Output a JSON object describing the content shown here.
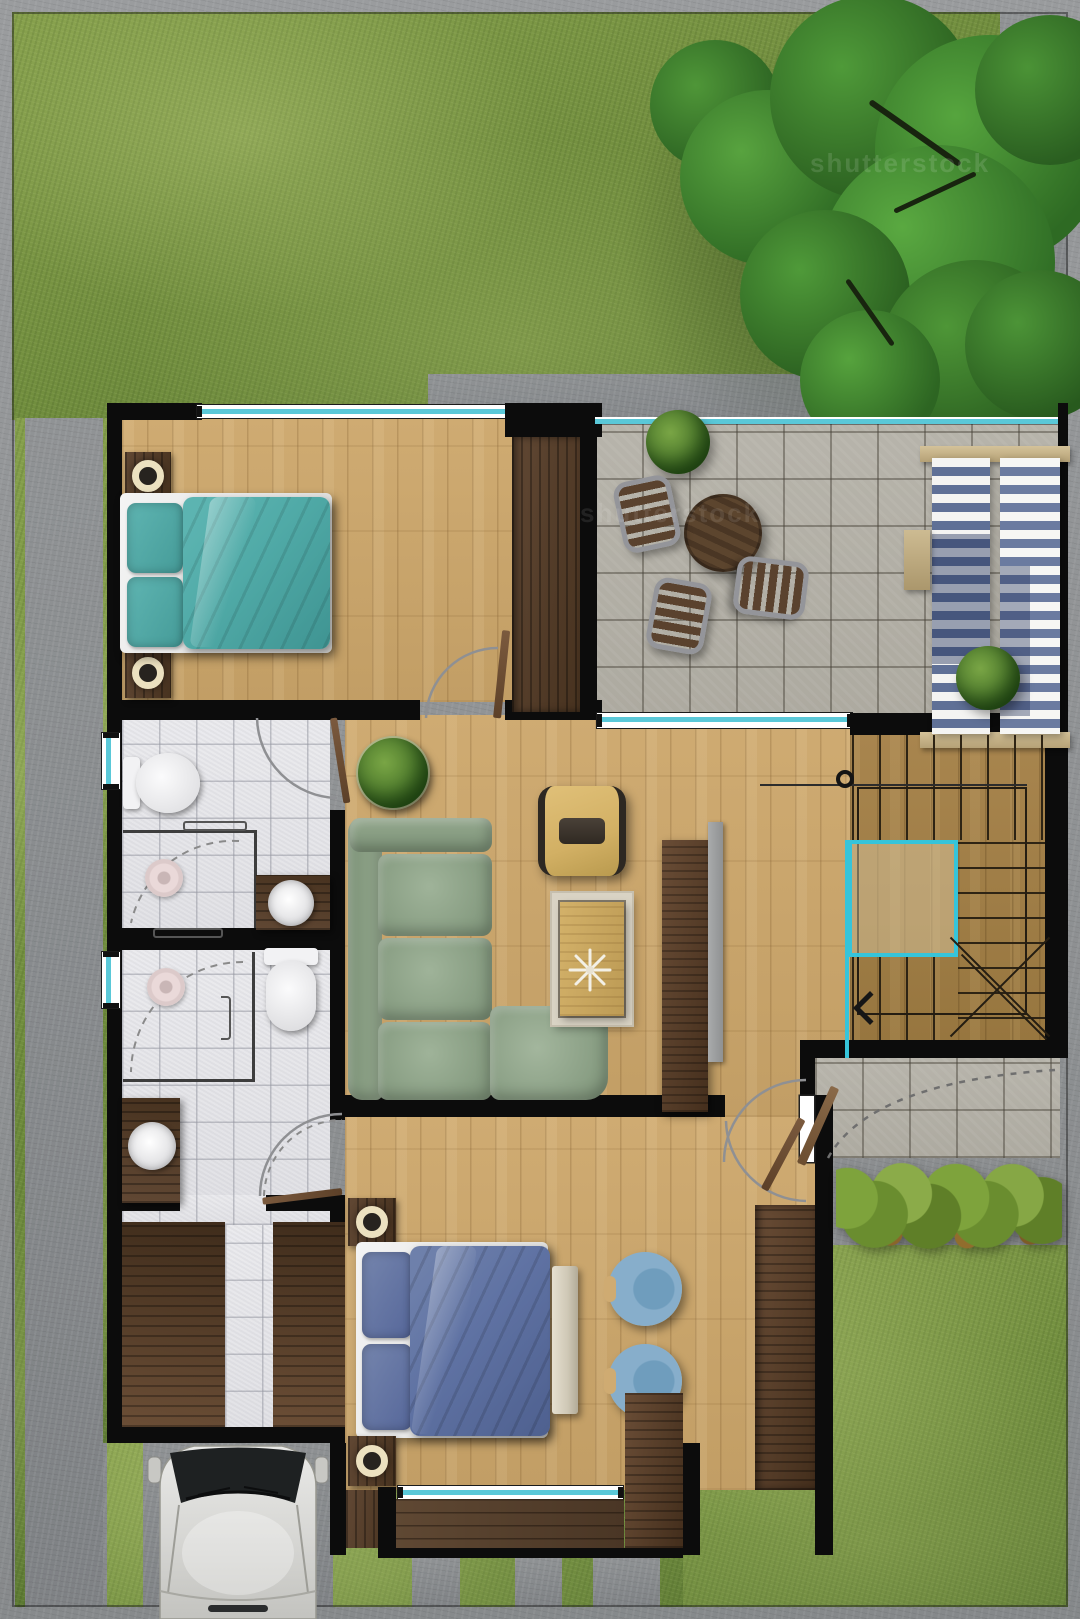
{
  "meta": {
    "title": "house-first-floor-plan-top-view",
    "view": "top-down architectural rendering"
  },
  "watermarks": [
    {
      "text": "shutterstock"
    },
    {
      "text": "shutterstock"
    }
  ],
  "palette": {
    "wall": "#0c0c0c",
    "oak": "#cfab72",
    "oak_dark": "#c29e65",
    "stair": "#a8854e",
    "stair_dark": "#97763f",
    "darkwood": "#47321f",
    "darkwood_hi": "#614834",
    "deck": "#5f4833",
    "tile": "#b7b4ab",
    "bathtile": "#ebebee",
    "grass": "#6f8c3d",
    "grass_light": "#86a04c",
    "grass_dark": "#5d7a33",
    "concrete": "#909395",
    "concrete_dark": "#7f8285",
    "teal": "#50aaa7",
    "teal_deep": "#3f9492",
    "blue": "#5f72a3",
    "blue_deep": "#4e608f",
    "linen": "#f1f1f2",
    "sofa": "#93a78d",
    "sofa_deep": "#7d9378",
    "armchair": "#d2b064",
    "chair_blue": "#84adca",
    "glass": "#5ac8d8",
    "cyan": "#36c4da",
    "lamp": "#ece1c0",
    "car": "#d8d8d5",
    "hedge": "#6b8c2f",
    "tree": "#3f7d2f",
    "rug": "#d9d3c4",
    "bench": "#cfc8b6"
  },
  "rooms": [
    {
      "name": "bedroom-1",
      "furniture": [
        "double-bed-teal",
        "nightstand-with-lamp",
        "nightstand-with-lamp",
        "wardrobe"
      ]
    },
    {
      "name": "terrace-patio",
      "furniture": [
        "round-table",
        "patio-chair",
        "patio-chair",
        "patio-chair",
        "sun-lounger",
        "sun-lounger",
        "side-table",
        "shrub",
        "shrub"
      ]
    },
    {
      "name": "bathroom-1",
      "furniture": [
        "toilet",
        "shower",
        "washbasin-counter"
      ]
    },
    {
      "name": "bathroom-2",
      "furniture": [
        "shower",
        "toilet",
        "washbasin-counter"
      ]
    },
    {
      "name": "living-room",
      "furniture": [
        "corner-sofa-green",
        "armchair-yellow",
        "coffee-table-on-rug",
        "tv-console",
        "tv",
        "potted-plant"
      ]
    },
    {
      "name": "staircase",
      "furniture": [
        "u-shaped-stairs",
        "landing",
        "direction-arrow"
      ]
    },
    {
      "name": "entry-porch",
      "furniture": [
        "front-door",
        "hedge"
      ]
    },
    {
      "name": "bedroom-2",
      "furniture": [
        "double-bed-blue",
        "nightstand-with-lamp",
        "nightstand-with-lamp",
        "bench",
        "round-chair",
        "round-chair",
        "wardrobe",
        "terrace-deck"
      ]
    },
    {
      "name": "dressing-garage",
      "furniture": [
        "wardrobe-left",
        "wardrobe-right",
        "tile-walkway"
      ]
    },
    {
      "name": "garden",
      "furniture": [
        "large-tree",
        "lawn",
        "hedge"
      ]
    },
    {
      "name": "driveway",
      "furniture": [
        "car",
        "concrete-strips"
      ]
    }
  ]
}
